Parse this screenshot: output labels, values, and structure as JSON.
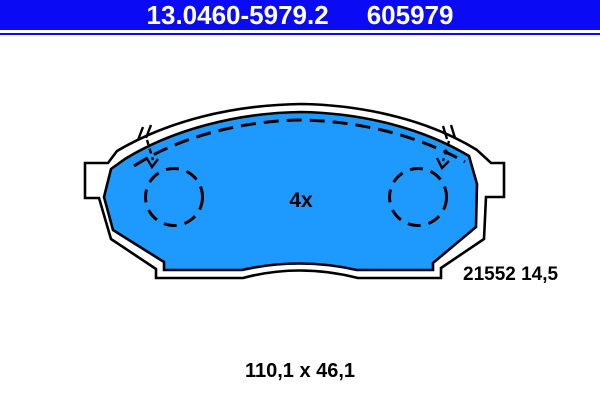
{
  "header": {
    "part_number": "13.0460-5979.2",
    "reference_number": "605979"
  },
  "diagram": {
    "quantity_label": "4x",
    "pad_code": "21552 14,5",
    "dimensions": "110,1 x 46,1"
  },
  "colors": {
    "header_background": "#0a0af5",
    "header_text": "#ffffff",
    "pad_fill": "#1e9aff",
    "plate_fill": "#ffffff",
    "outline": "#000000",
    "label_text": "#000000"
  }
}
